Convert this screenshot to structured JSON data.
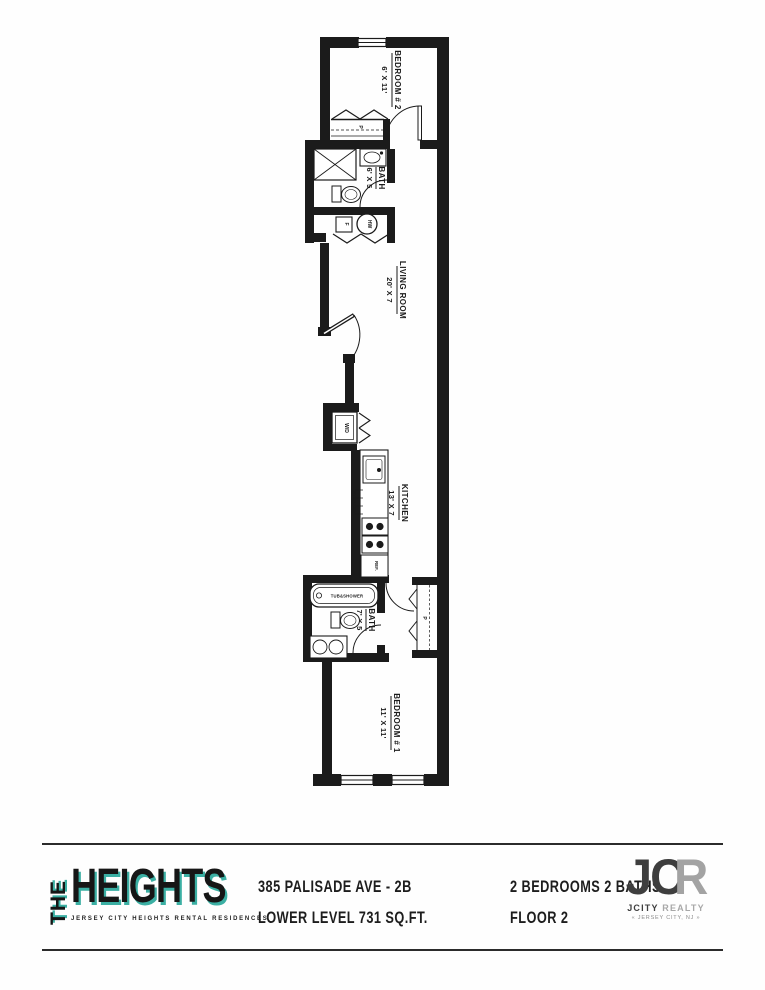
{
  "colors": {
    "teal": "#3BAFA3",
    "wall": "#1b1b1b",
    "charcoal": "#3e3e3e",
    "gray": "#a3a3a3"
  },
  "plan": {
    "bedroom2": {
      "name": "BEDROOM # 2",
      "dim": "6' X 11'"
    },
    "bath1": {
      "name": "BATH",
      "dim": "6' X 5"
    },
    "living": {
      "name": "LIVING ROOM",
      "dim": "20' X 7"
    },
    "kitchen": {
      "name": "KITCHEN",
      "dim": "13' X 7"
    },
    "bath2": {
      "name": "BATH",
      "dim": "7' X 5"
    },
    "bedroom1": {
      "name": "BEDROOM # 1",
      "dim": "11' X 11'"
    },
    "closet_top": "P",
    "closet_bottom": "P",
    "furnace": "F",
    "water_heater": "HW",
    "washer_dryer": "W/D",
    "storage": "STORAGE",
    "fridge": "REF.",
    "tub": "TUB&SHOWER"
  },
  "footer": {
    "brand": {
      "the": "THE",
      "heights": "HEIGHTS",
      "tagline": "JERSEY CITY HEIGHTS RENTAL RESIDENCES"
    },
    "unit": {
      "line1": "385 PALISADE AVE - 2B",
      "line2": "LOWER LEVEL 731 SQ.FT."
    },
    "specs": {
      "line1": "2 BEDROOMS 2 BATHS",
      "line2": "FLOOR 2"
    },
    "realty": {
      "jc": "JC",
      "r": "R",
      "name1": "JCITY",
      "name2": "REALTY",
      "location": "« JERSEY CITY, NJ »"
    }
  }
}
